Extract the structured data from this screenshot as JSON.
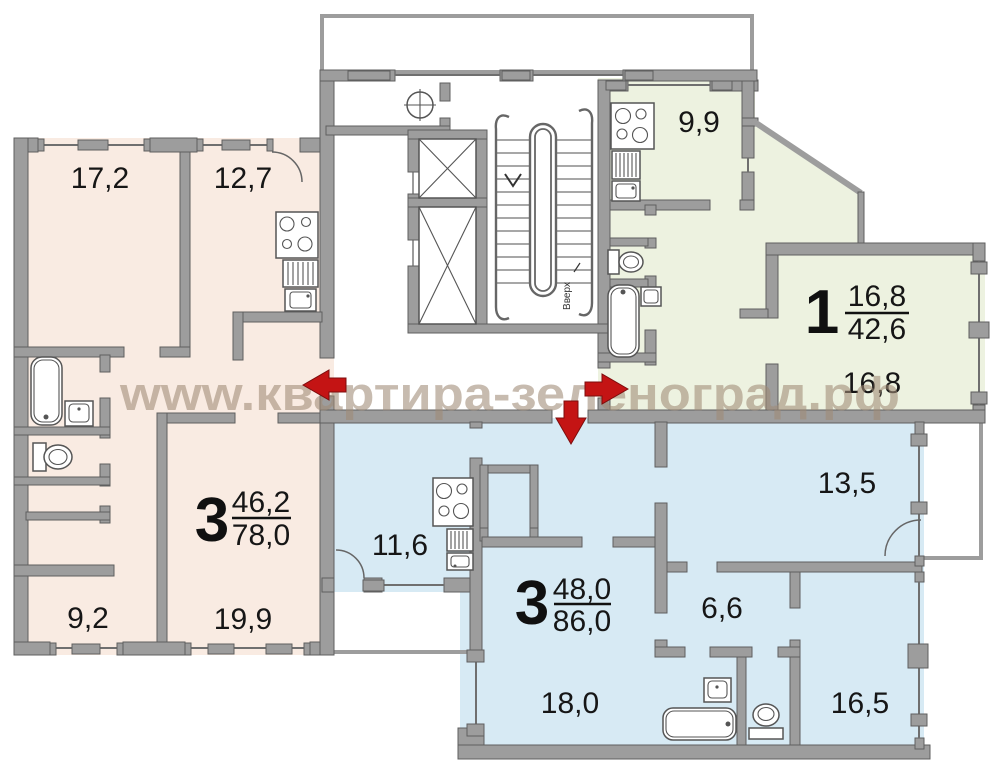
{
  "watermark": {
    "text": "www.квартира-зеленоград.рф",
    "color": "#a08b76"
  },
  "plan": {
    "stair_direction_label": "Вверх",
    "entry_arrow_color": "#c41414",
    "wall_color": "#9d9d9d"
  },
  "apartments": {
    "left_3room": {
      "number": "3",
      "living_area": "46,2",
      "total_area": "78,0",
      "color": "#f9ebe2",
      "rooms": {
        "bedroom1": "17,2",
        "kitchen": "12,7",
        "bedroom2": "9,2",
        "living_room": "19,9"
      }
    },
    "right_1room": {
      "number": "1",
      "living_area": "16,8",
      "total_area": "42,6",
      "color": "#edf2e0",
      "rooms": {
        "kitchen": "9,9",
        "living_room": "16,8"
      }
    },
    "bottom_3room": {
      "number": "3",
      "living_area": "48,0",
      "total_area": "86,0",
      "color": "#d7eaf4",
      "rooms": {
        "kitchen": "11,6",
        "bedroom1": "13,5",
        "hallway": "6,6",
        "bedroom2": "16,5",
        "living_room": "18,0"
      }
    }
  }
}
